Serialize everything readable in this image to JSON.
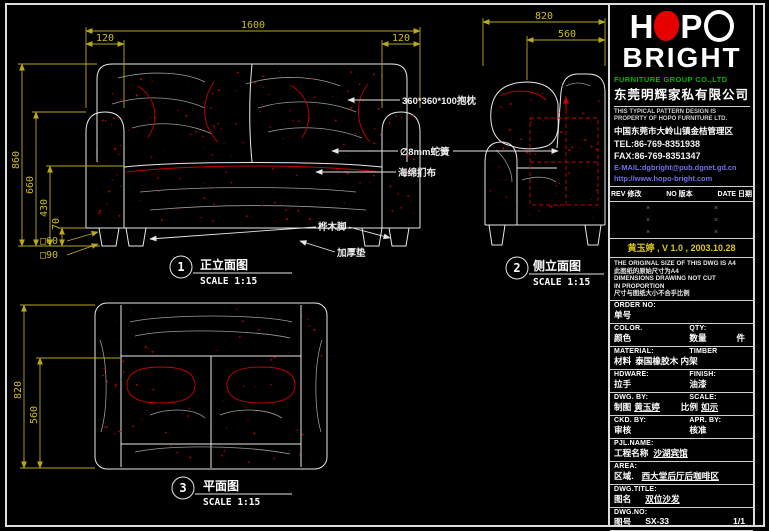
{
  "colors": {
    "dim_yellow": "#b9a81c",
    "accent_red": "#c80000",
    "logo_red": "#e60000",
    "brand_green": "#00b400",
    "link_blue": "#7070e8"
  },
  "drawing": {
    "views": [
      {
        "num": "1",
        "title": "正立面图",
        "scale": "SCALE 1:15"
      },
      {
        "num": "2",
        "title": "侧立面图",
        "scale": "SCALE 1:15"
      },
      {
        "num": "3",
        "title": "平面图",
        "scale": "SCALE 1:15"
      }
    ],
    "dims": {
      "front": {
        "total_width": "1600",
        "arm_left": "120",
        "arm_right": "120",
        "total_height": "860",
        "arm_height": "660",
        "seat_height": "430",
        "leg_height": "70",
        "leg_square_top": "□60",
        "leg_square_bottom": "□90"
      },
      "side": {
        "total_depth": "820",
        "seat_depth": "560"
      },
      "plan": {
        "total_depth": "820",
        "seat_depth": "560"
      }
    },
    "annotations": {
      "pillow": "360*360*100抱枕",
      "spring": "∅8mm蛇簧",
      "upholstery": "海绵扪布",
      "leg": "桦木脚",
      "pad": "加厚垫"
    }
  },
  "titleblock": {
    "logo": {
      "h": "H",
      "p": "P",
      "line2": "BRIGHT"
    },
    "company_en": "FURNITURE GROUP CO.,LTD",
    "company_cn": "东莞明辉家私有限公司",
    "legal": [
      "THIS TYPICAL PATTERN DESIGN IS",
      "PROPERTY OF HOPO FURNITURE LTD."
    ],
    "address_cn": "中国东莞市大岭山镇金桔管理区",
    "tel": "TEL:86-769-8351938",
    "fax": "FAX:86-769-8351347",
    "email": "E-MAIL:dgbright@pub.dgnet.gd.cn",
    "website": "http://www.hopo-bright.com",
    "rev_headers": [
      "REV 修改",
      "NO 版本",
      "DATE 日期"
    ],
    "rev_mark": "×",
    "sig_line": "黄玉婷 , V 1.0 , 2003.10.28",
    "notes": [
      "THE ORIGINAL SIZE OF THIS DWG IS A4",
      "此图纸的原始尺寸为A4",
      "DIMENSIONS DRAWING NOT CUT",
      "IN PROPORTION",
      "尺寸与图纸大小不合乎比例"
    ],
    "fields": {
      "order": {
        "en": "ORDER NO:",
        "cn": "单号"
      },
      "color": {
        "en": "COLOR.",
        "cn": "颜色"
      },
      "qty": {
        "en": "QTY:",
        "cn": "数量",
        "unit": "件"
      },
      "material": {
        "en": "MATERIAL:",
        "value_en": "TIMBER",
        "cn": "材料",
        "value_cn": "泰国橡胶木 内架"
      },
      "hardware": {
        "en": "HDWARE:",
        "cn": "拉手"
      },
      "finish": {
        "en": "FINISH:",
        "cn": "油漆"
      },
      "dwg_by": {
        "en": "DWG. BY:",
        "cn": "制图",
        "value": "黄玉婷"
      },
      "scale": {
        "en": "SCALE:",
        "cn": "比例",
        "value": "如示"
      },
      "ckd_by": {
        "en": "CKD. BY:",
        "cn": "审核"
      },
      "apr_by": {
        "en": "APR. BY:",
        "cn": "核准"
      },
      "pjl_name": {
        "en": "PJL.NAME:",
        "cn": "工程名称",
        "value": "沙湖宾馆"
      },
      "area": {
        "en": "AREA:",
        "cn": "区域.",
        "value": "西大堂后厅后咖啡区"
      },
      "dwg_title": {
        "en": "DWG.TITLE:",
        "cn": "图名",
        "value": "双位沙发"
      },
      "dwg_no": {
        "en": "DWG.NO:",
        "cn": "图号",
        "value": "SX-33",
        "sheet": "1/1"
      },
      "path": {
        "en": "PATH:",
        "cn": "路径.",
        "value": "E/01/01/01/0146"
      }
    }
  }
}
